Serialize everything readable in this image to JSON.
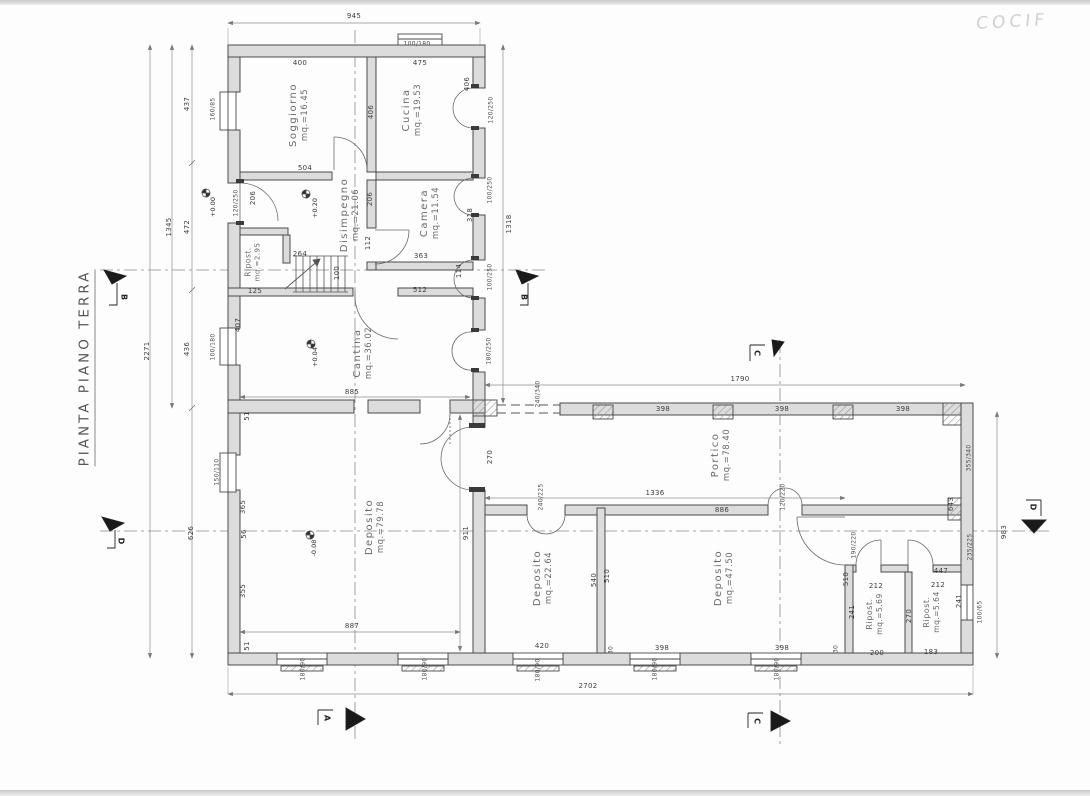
{
  "title": "PIANTA PIANO TERRA",
  "annotation": "COCIF",
  "rooms": [
    {
      "name": "Soggiorno",
      "area": "mq.=16.45"
    },
    {
      "name": "Cucina",
      "area": "mq.=19.53"
    },
    {
      "name": "Disimpegno",
      "area": "mq.=21.06"
    },
    {
      "name": "Camera",
      "area": "mq.=11.54"
    },
    {
      "name": "Ripost.",
      "area": "mq.=2.95"
    },
    {
      "name": "Cantina",
      "area": "mq.=36.02"
    },
    {
      "name": "Deposito",
      "area": "mq.=79.78"
    },
    {
      "name": "Portico",
      "area": "mq.=78.40"
    },
    {
      "name": "Deposito",
      "area": "mq.=22.64"
    },
    {
      "name": "Deposito",
      "area": "mq.=47.50"
    },
    {
      "name": "Ripost.",
      "area": "mq.=5.69"
    },
    {
      "name": "Ripost.",
      "area": "mq.=5.64"
    }
  ],
  "levels": {
    "l1": "+0.00",
    "l2": "+0.20",
    "l3": "+0.04",
    "l4": "-0.08"
  },
  "sections": {
    "a": "A",
    "b": "B",
    "c": "C",
    "d": "D"
  },
  "d": {
    "945": "945",
    "400": "400",
    "475": "475",
    "504": "504",
    "206": "206",
    "264": "264",
    "363": "363",
    "125": "125",
    "512": "512",
    "885": "885",
    "100": "100",
    "112": "112",
    "318": "318",
    "114": "114",
    "406": "406",
    "407": "407",
    "437": "437",
    "472": "472",
    "436": "436",
    "626": "626",
    "1345": "1345",
    "2271": "2271",
    "1318": "1318",
    "1790": "1790",
    "983": "983",
    "911": "911",
    "643": "643",
    "887": "887",
    "398": "398",
    "1336": "1336",
    "886": "886",
    "420": "420",
    "540": "540",
    "510": "510",
    "241": "241",
    "212": "212",
    "447": "447",
    "270": "270",
    "200": "200",
    "183": "183",
    "2702": "2702",
    "30": "30",
    "51": "51",
    "365": "365",
    "56": "56",
    "355": "355",
    "160/85": "160/85",
    "100/180": "100/180",
    "150/110": "150/110",
    "100/65": "100/65",
    "180/90": "180/90",
    "355/340": "355/340",
    "235/225": "235/225",
    "240/225": "240/225",
    "120/220": "120/220",
    "190/220": "190/220",
    "240/340": "240/340",
    "120/250": "120/250",
    "100/250": "100/250",
    "180/250": "180/250"
  }
}
